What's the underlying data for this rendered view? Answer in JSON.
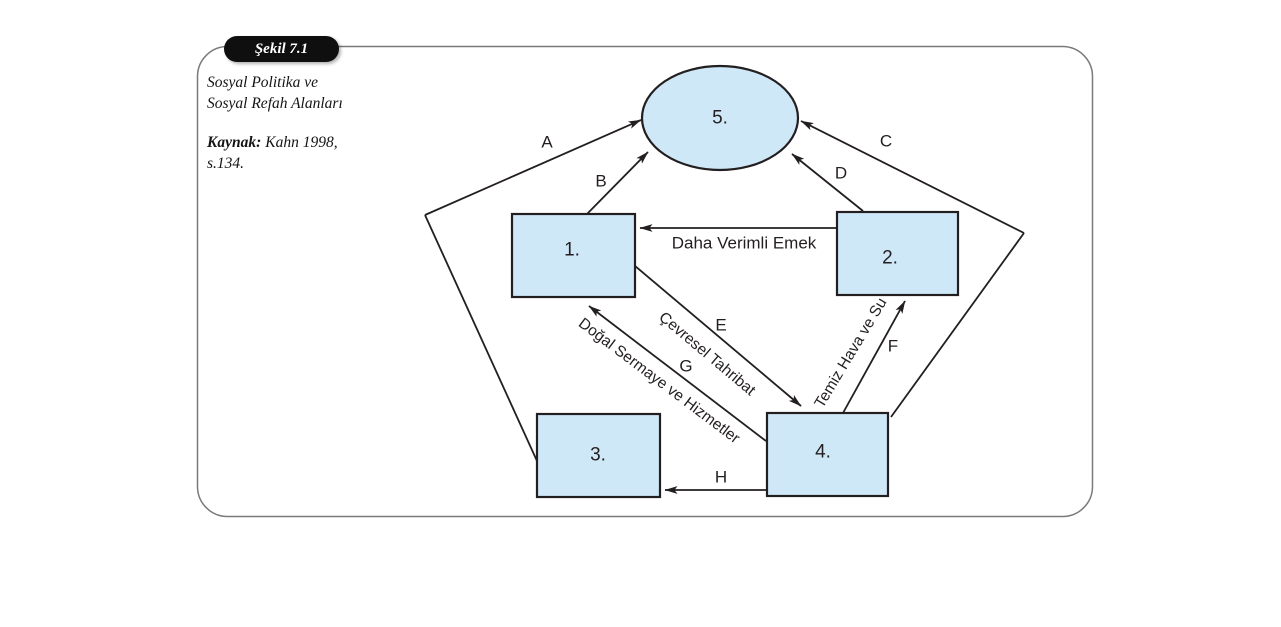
{
  "figure": {
    "badge_label": "Şekil 7.1",
    "caption_line1": "Sosyal Politika ve",
    "caption_line2": "Sosyal Refah Alanları",
    "source_label": "Kaynak:",
    "source_text": "Kahn 1998,",
    "source_line2": "s.134."
  },
  "nodes": {
    "n1": "1.",
    "n2": "2.",
    "n3": "3.",
    "n4": "4.",
    "n5": "5."
  },
  "arrow_letters": {
    "a": "A",
    "b": "B",
    "c": "C",
    "d": "D",
    "e": "E",
    "f": "F",
    "g": "G",
    "h": "H"
  },
  "flow_labels": {
    "more_productive_labor": "Daha Verimli Emek",
    "environmental_damage": "Çevresel Tahribat",
    "natural_capital_services": "Doğal Sermaye ve Hizmetler",
    "clean_air_water": "Temiz Hava ve Su"
  },
  "colors": {
    "node_fill": "#cfe8f8",
    "line": "#231f20",
    "frame_border": "#7a7a7a",
    "badge_bg": "#0f0f0f",
    "badge_text": "#ffffff"
  }
}
